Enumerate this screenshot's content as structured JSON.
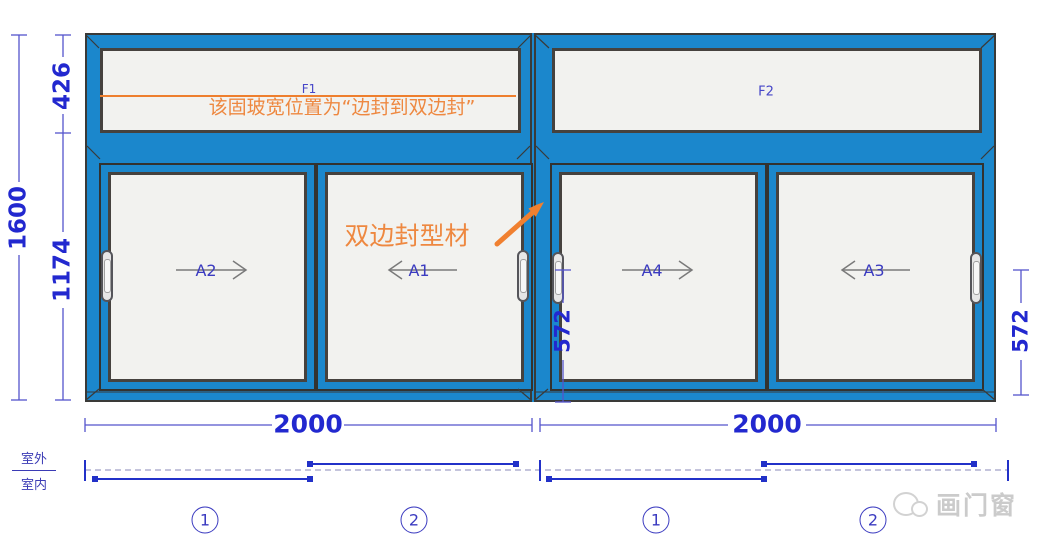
{
  "drawing": {
    "fixed_panels": [
      {
        "label": "F1"
      },
      {
        "label": "F2"
      }
    ],
    "sashes": [
      {
        "label": "A2",
        "slide": "right"
      },
      {
        "label": "A1",
        "slide": "left"
      },
      {
        "label": "A4",
        "slide": "right"
      },
      {
        "label": "A3",
        "slide": "left"
      }
    ],
    "annotations": {
      "fixed_glass_note": "该固玻宽位置为“边封到双边封”",
      "mullion_note": "双边封型材"
    }
  },
  "dimensions": {
    "total_height": "1600",
    "top_fixed_height": "426",
    "slider_height": "1174",
    "mid_sash_height": "572",
    "right_sash_height": "572",
    "left_width": "2000",
    "right_width": "2000"
  },
  "track_diagram": {
    "outside_label": "室外",
    "inside_label": "室内",
    "positions": [
      "1",
      "2",
      "1",
      "2"
    ]
  },
  "watermark": {
    "brand": "画门窗"
  },
  "colors": {
    "frame_blue": "#1b87cc",
    "dimension_blue": "#2228cf",
    "annotation_orange": "#ee8840"
  }
}
